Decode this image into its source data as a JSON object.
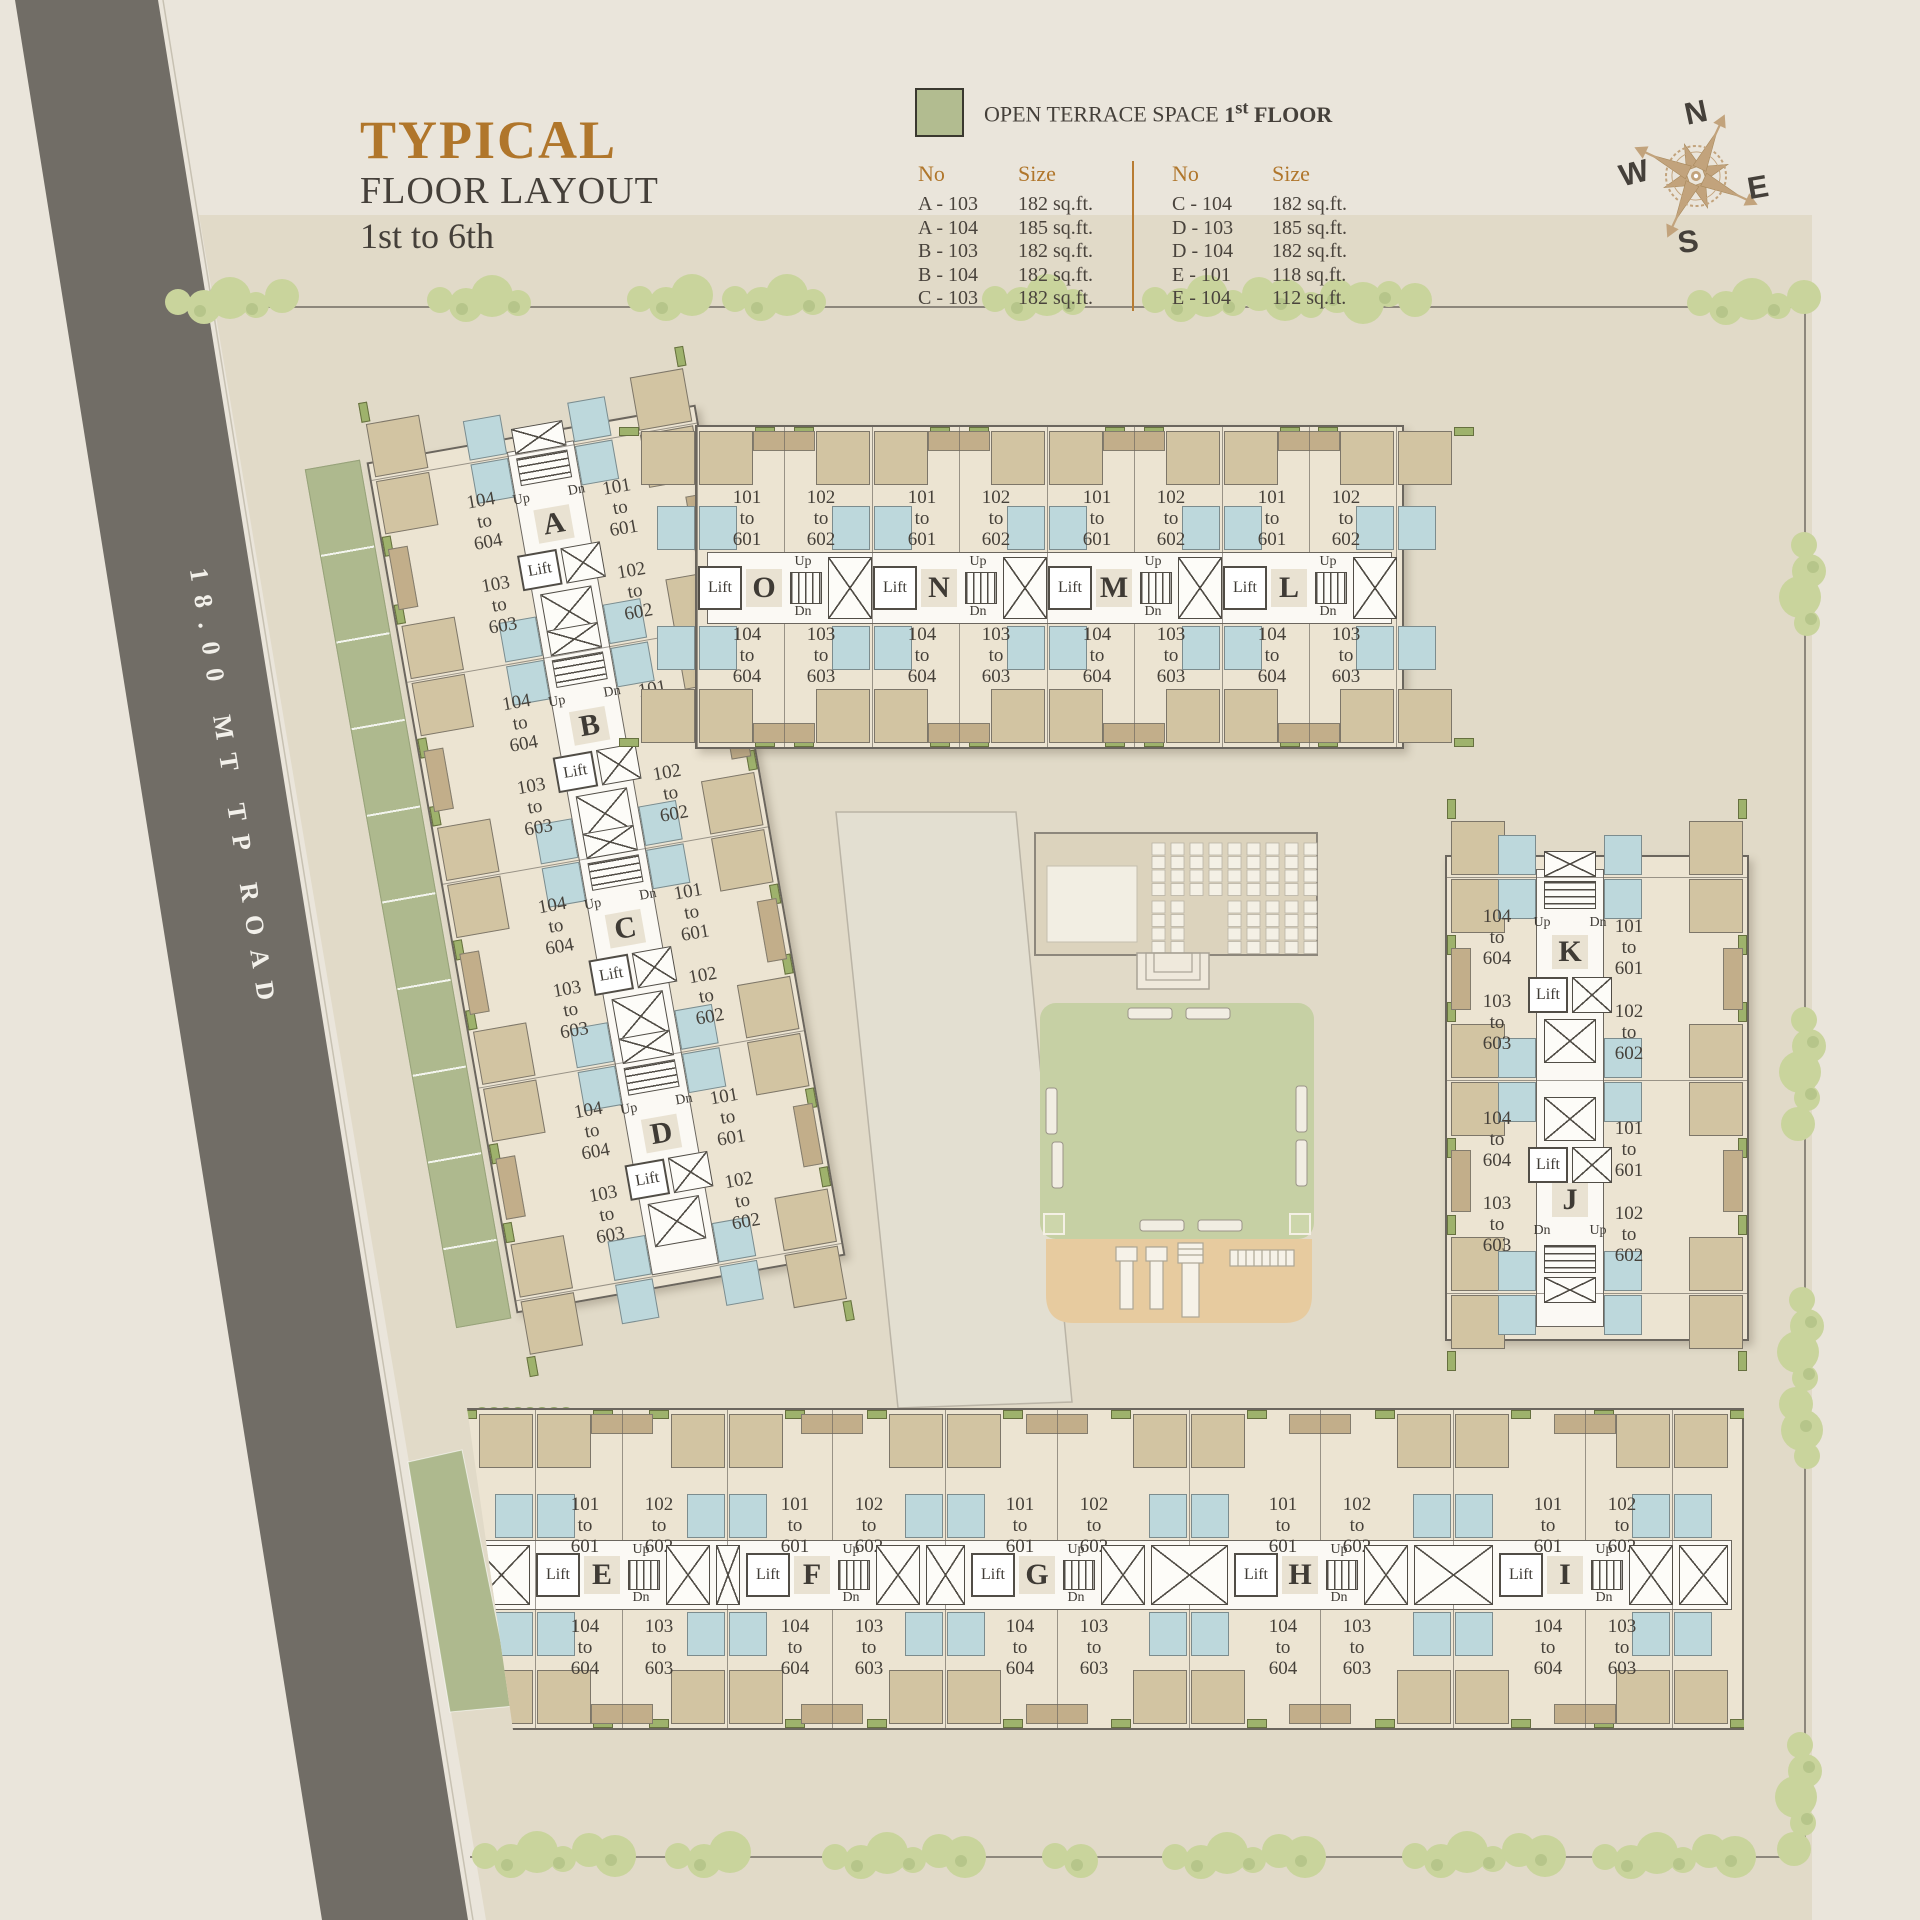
{
  "title": {
    "line1": "TYPICAL",
    "line2": "FLOOR LAYOUT",
    "line3": "1st to 6th"
  },
  "legend": {
    "swatch_color": "#b2bc90",
    "label_regular": "OPEN TERRACE SPACE ",
    "label_num": "1",
    "label_sup": "st",
    "label_rest": " FLOOR",
    "columns": [
      {
        "no_header": "No",
        "size_header": "Size",
        "rows": [
          [
            "A - 103",
            "182 sq.ft."
          ],
          [
            "A - 104",
            "185 sq.ft."
          ],
          [
            "B - 103",
            "182 sq.ft."
          ],
          [
            "B - 104",
            "182 sq.ft."
          ],
          [
            "C - 103",
            "182 sq.ft."
          ]
        ]
      },
      {
        "no_header": "No",
        "size_header": "Size",
        "rows": [
          [
            "C - 104",
            "182 sq.ft."
          ],
          [
            "D - 103",
            "185 sq.ft."
          ],
          [
            "D - 104",
            "182 sq.ft."
          ],
          [
            "E - 101",
            "118 sq.ft."
          ],
          [
            "E - 104",
            "112 sq.ft."
          ]
        ]
      }
    ]
  },
  "compass": {
    "n": "N",
    "e": "E",
    "s": "S",
    "w": "W"
  },
  "road": {
    "label": "18.00 MT TP ROAD"
  },
  "site": {
    "buildings": [
      {
        "id": "west",
        "cores": [
          "A",
          "B",
          "C",
          "D"
        ]
      },
      {
        "id": "north",
        "cores": [
          "O",
          "N",
          "M",
          "L"
        ]
      },
      {
        "id": "east",
        "cores": [
          "K",
          "J"
        ]
      },
      {
        "id": "south",
        "cores": [
          "E",
          "F",
          "G",
          "H",
          "I"
        ]
      }
    ],
    "unit_labels": {
      "u101": [
        "101",
        "to",
        "601"
      ],
      "u102": [
        "102",
        "to",
        "602"
      ],
      "u103": [
        "103",
        "to",
        "603"
      ],
      "u104": [
        "104",
        "to",
        "604"
      ]
    },
    "core_text": {
      "lift": "Lift",
      "up": "Up",
      "dn": "Dn"
    }
  }
}
